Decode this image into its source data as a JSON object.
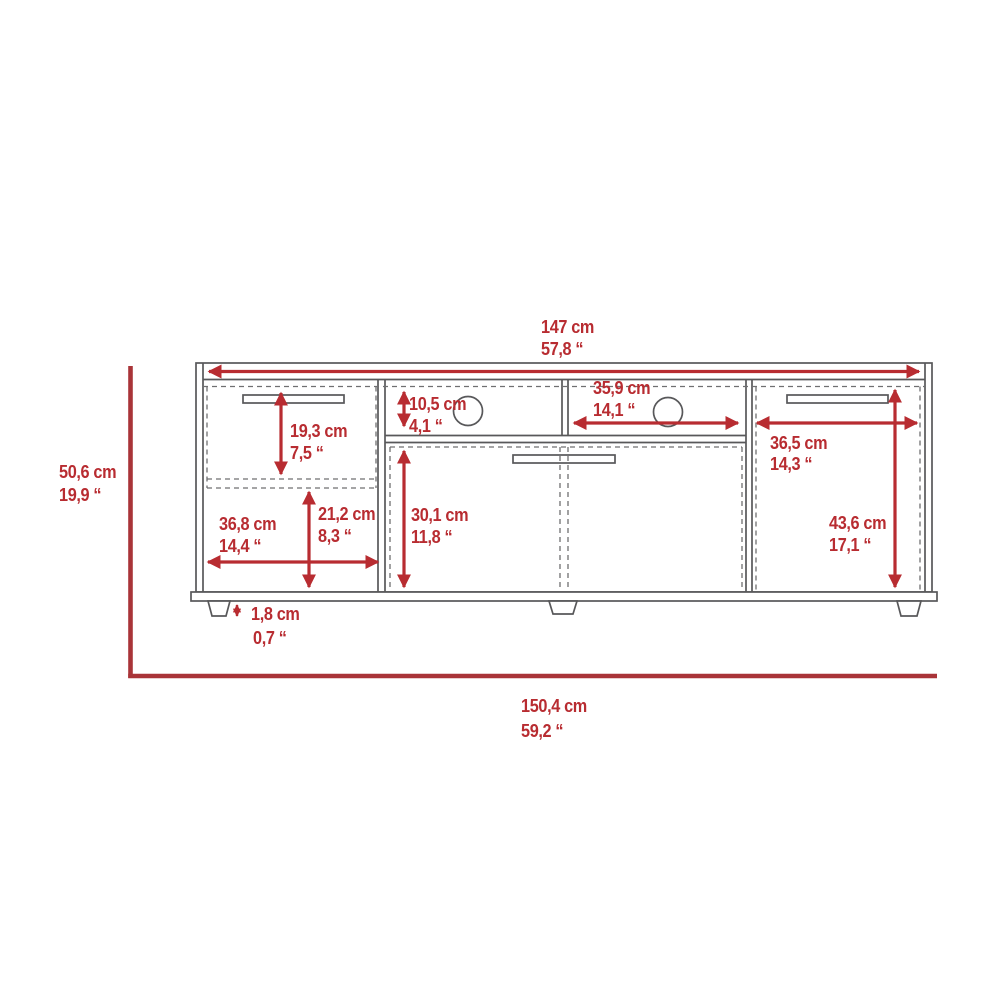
{
  "diagram": {
    "type": "furniture-dimension-drawing",
    "subject": "TV stand with drawer, open shelves, cable holes and doors",
    "units_shown": [
      "cm",
      "inches"
    ],
    "colors": {
      "dimension_red": "#b82c31",
      "bracket_red": "#a93438",
      "outline_gray": "#58585a",
      "dashed_gray": "#6f6f71",
      "background": "#ffffff"
    },
    "dimensions": {
      "overall_width": {
        "cm": "147 cm",
        "inches": "57,8 “"
      },
      "overall_height": {
        "cm": "50,6 cm",
        "inches": "19,9 “"
      },
      "overall_footprint_width": {
        "cm": "150,4 cm",
        "inches": "59,2 “"
      },
      "open_shelf_width": {
        "cm": "35,9 cm",
        "inches": "14,1 “"
      },
      "open_shelf_height": {
        "cm": "10,5 cm",
        "inches": "4,1 “"
      },
      "left_drawer_height": {
        "cm": "19,3 cm",
        "inches": "7,5 “"
      },
      "right_door_width": {
        "cm": "36,5 cm",
        "inches": "14,3 “"
      },
      "left_compartment_width": {
        "cm": "36,8 cm",
        "inches": "14,4 “"
      },
      "left_compartment_height": {
        "cm": "21,2 cm",
        "inches": "8,3 “"
      },
      "center_cabinet_height": {
        "cm": "30,1 cm",
        "inches": "11,8 “"
      },
      "right_door_height": {
        "cm": "43,6 cm",
        "inches": "17,1 “"
      },
      "foot_height": {
        "cm": "1,8 cm",
        "inches": "0,7 “"
      }
    }
  }
}
